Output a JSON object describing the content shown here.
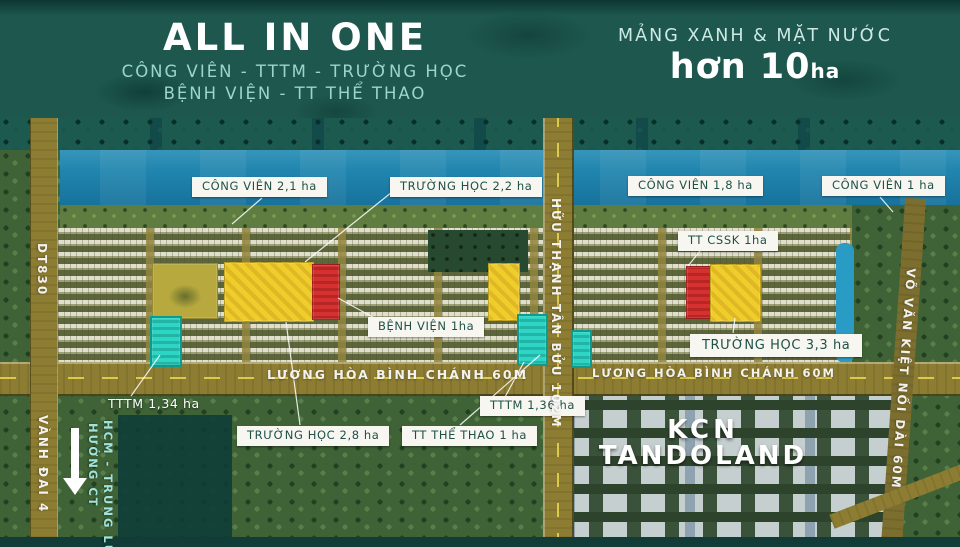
{
  "header": {
    "left": {
      "title": "ALL IN ONE",
      "subtitle_line1": "CÔNG VIÊN - TTTM - TRƯỜNG HỌC",
      "subtitle_line2": "BỆNH VIỆN - TT THỂ THAO"
    },
    "right": {
      "subtitle": "MẢNG XANH & MẶT NƯỚC",
      "headline": "hơn 10",
      "headline_unit": "ha"
    }
  },
  "plot_labels": {
    "cong_vien_21": "CÔNG VIÊN 2,1 ha",
    "truong_hoc_22": "TRƯỜNG HỌC 2,2 ha",
    "cong_vien_18": "CÔNG VIÊN 1,8 ha",
    "cong_vien_1": "CÔNG VIÊN 1 ha",
    "tt_cssk": "TT CSSK 1ha",
    "benh_vien": "BỆNH VIỆN 1ha",
    "truong_hoc_33": "TRƯỜNG HỌC 3,3 ha",
    "tttm_134": "TTTM 1,34 ha",
    "truong_hoc_28": "TRƯỜNG HỌC 2,8 ha",
    "tt_the_thao": "TT THỂ THAO 1 ha",
    "tttm_136": "TTTM 1,36 ha"
  },
  "roads": {
    "luong_hoa_binh_chanh_left": "LƯƠNG HÒA BÌNH CHÁNH 60M",
    "luong_hoa_binh_chanh_right": "LƯƠNG HÒA BÌNH CHÁNH 60M",
    "huu_thanh_tan_buu": "HỮU THẠNH TÂN BỬU 102M",
    "vo_van_kiet": "VÕ VĂN KIỆT NỐI DÀI 60M",
    "dt830": "DT830",
    "vanh_dai_4": "VÀNH ĐAI 4"
  },
  "zones": {
    "kcn_line1": "KCN",
    "kcn_line2": "TANDOLAND"
  },
  "direction_sign": {
    "line1": "HƯỚNG CT",
    "line2": "HCM - TRUNG LƯƠNG"
  },
  "colors": {
    "header_teal": "#1d574e",
    "river_blue": "#2186af",
    "plot_yellow": "#efce2b",
    "plot_red": "#d43130",
    "plot_cyan": "#2ed5c4",
    "road_olive": "#8d7d33",
    "label_text": "#1f5148",
    "accent_teal_text": "#9ed5ca"
  }
}
